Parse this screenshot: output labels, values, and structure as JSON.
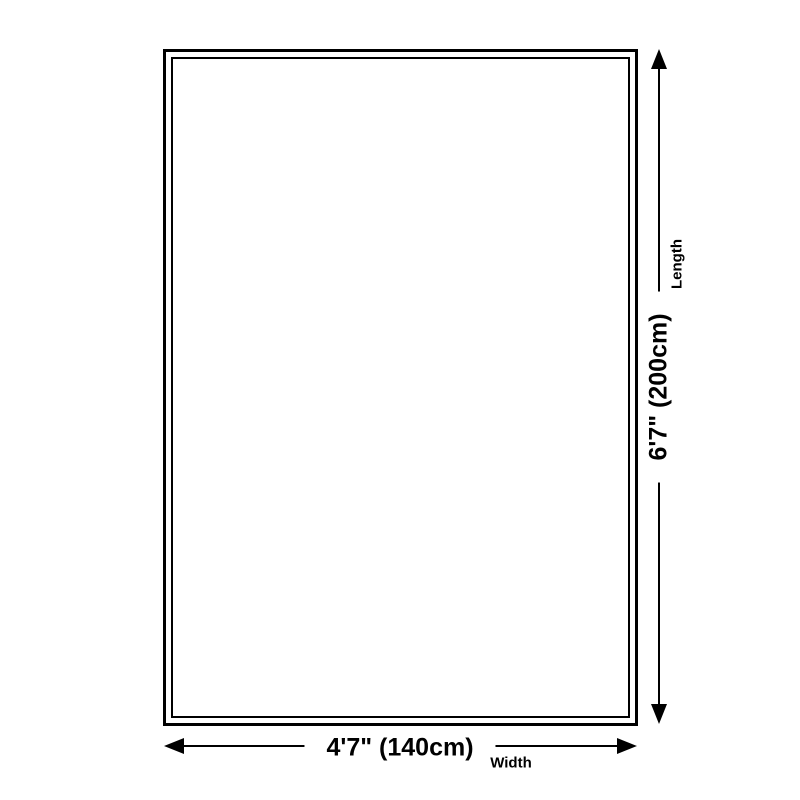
{
  "diagram": {
    "length": {
      "value": "6'7\" (200cm)",
      "label": "Length"
    },
    "width": {
      "value": "4'7\" (140cm)",
      "label": "Width"
    },
    "colors": {
      "line": "#000000",
      "background": "#ffffff"
    }
  }
}
